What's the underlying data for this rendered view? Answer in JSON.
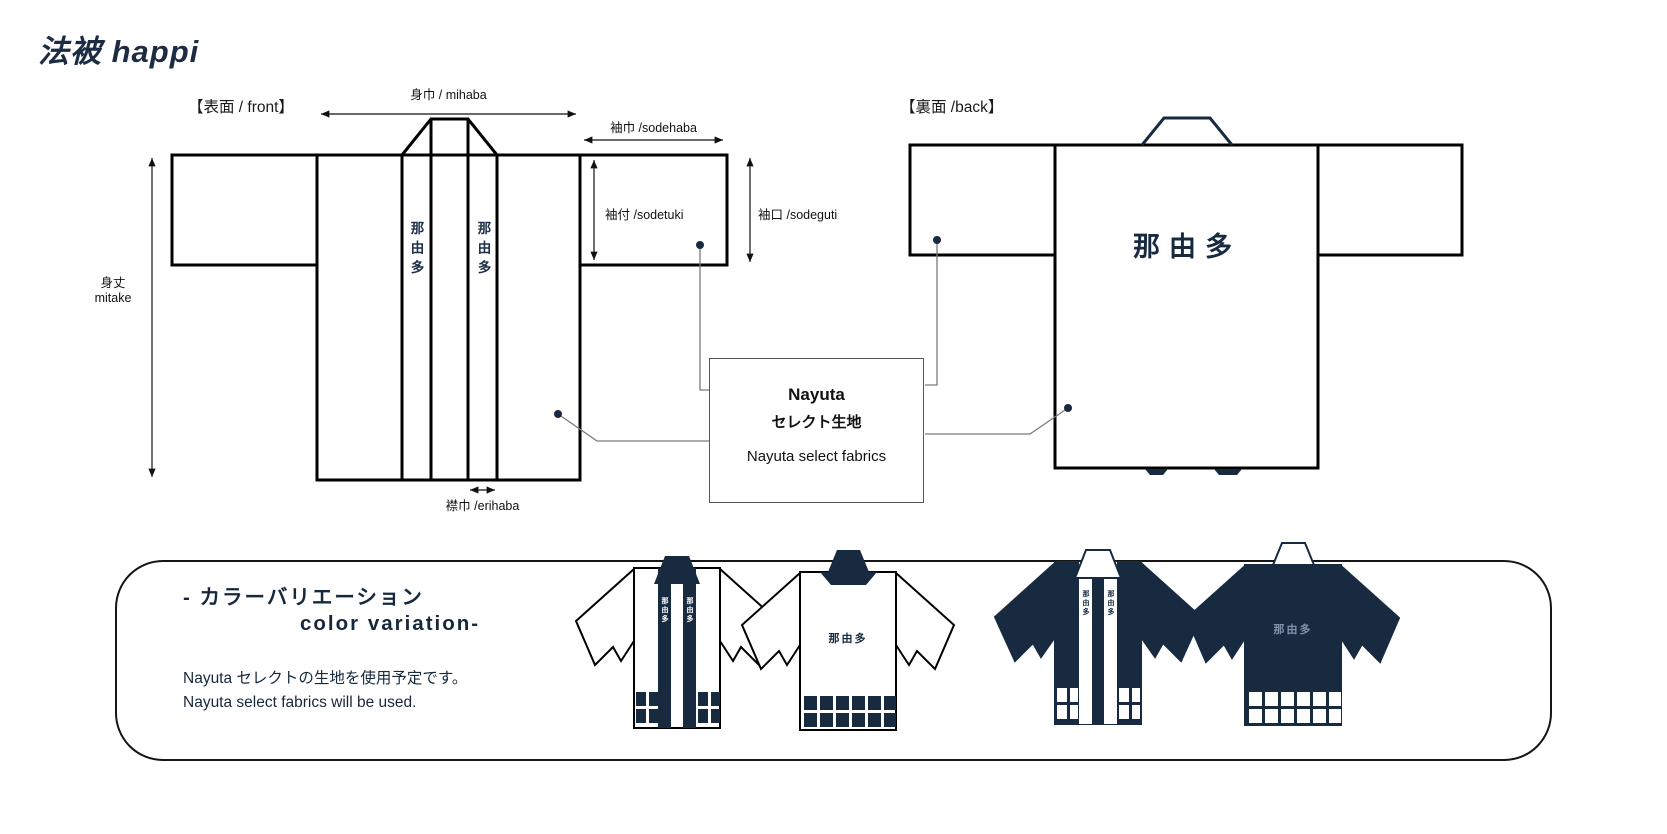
{
  "title": {
    "jp": "法被",
    "en": "happi"
  },
  "front": {
    "section": "【表面 / front】",
    "mihaba": "身巾 / mihaba",
    "sodehaba": "袖巾 /sodehaba",
    "sodetuki": "袖付 /sodetuki",
    "sodeguti": "袖口 /sodeguti",
    "mitake_jp": "身丈",
    "mitake_en": "mitake",
    "erihaba": "襟巾 /erihaba",
    "collar_text": "那由多"
  },
  "back": {
    "section": "【裏面 /back】",
    "print_text": "那由多"
  },
  "fabric_box": {
    "title": "Nayuta",
    "subtitle": "セレクト生地",
    "caption": "Nayuta select fabrics"
  },
  "variation": {
    "heading_jp": "- カラーバリエーション",
    "heading_en": "color variation-",
    "note_jp": "Nayuta セレクトの生地を使用予定です。",
    "note_en": "Nayuta select fabrics will be used.",
    "front_text": "那由多",
    "back_text": "那由多"
  },
  "colors": {
    "navy": "#182a40",
    "text_navy": "#16283c",
    "outline": "#000000",
    "connector": "#7a7a7a",
    "box_border": "#555555",
    "muted_print": "#8191a8"
  }
}
